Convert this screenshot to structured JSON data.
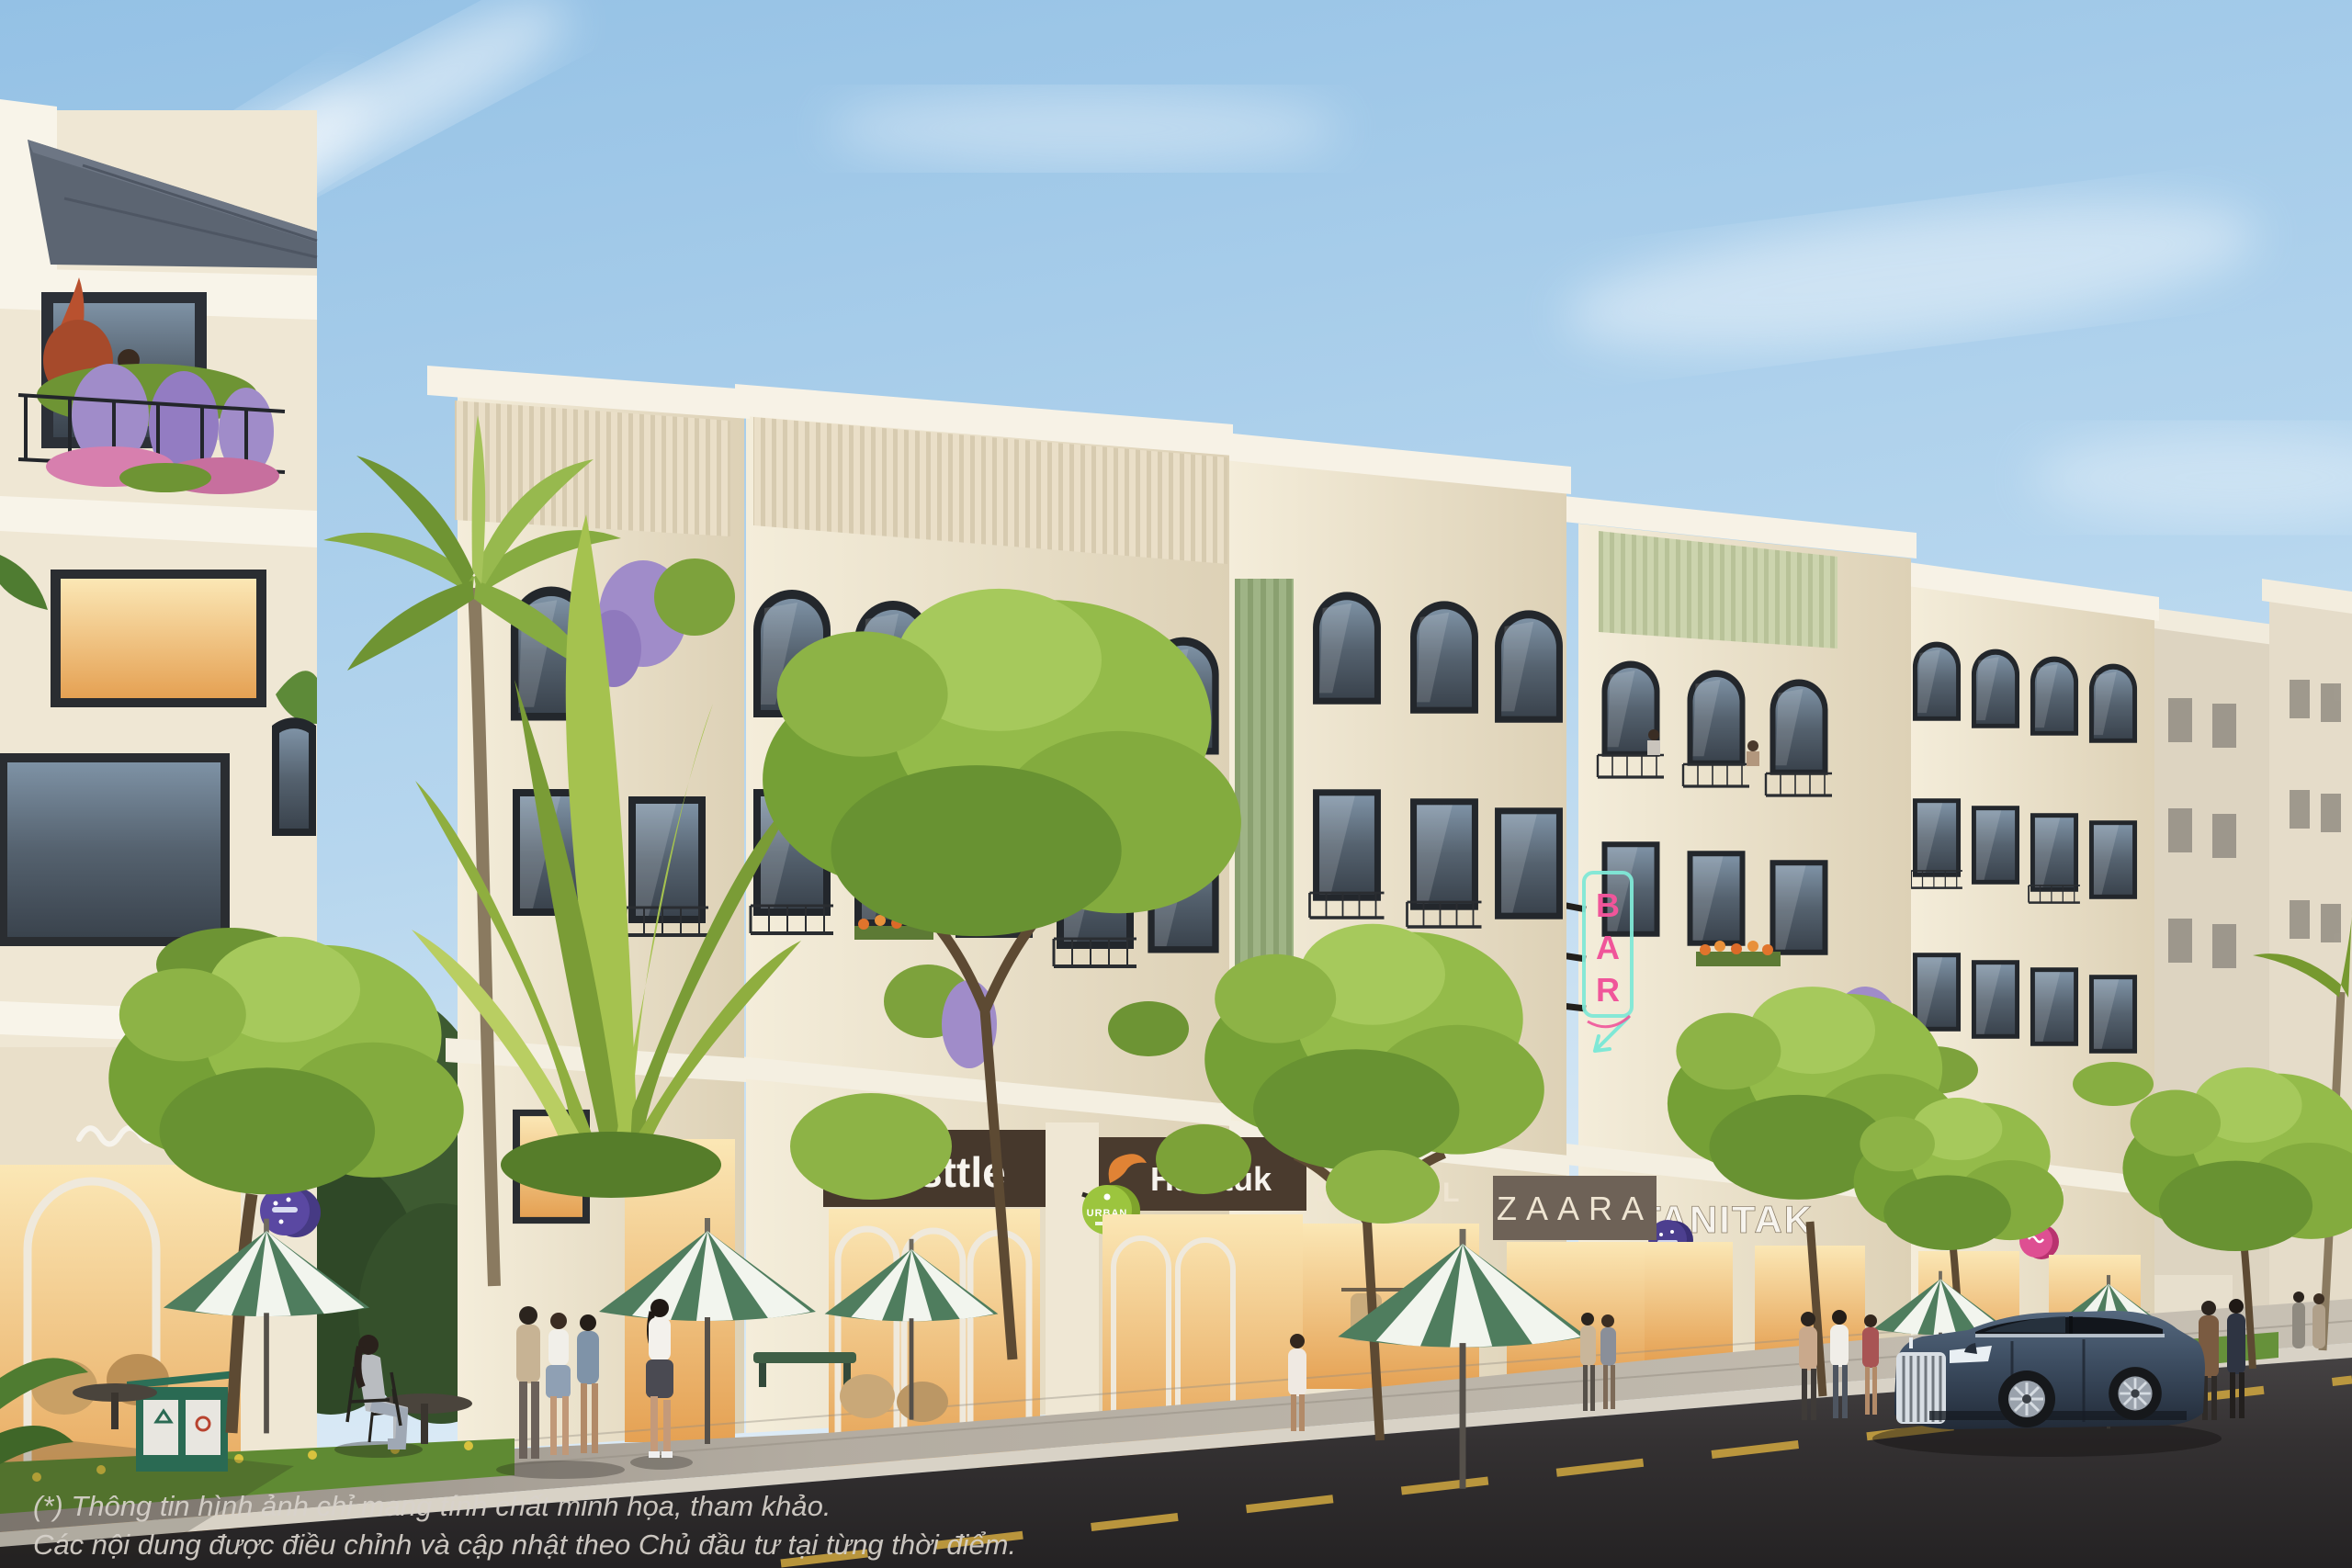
{
  "scene": {
    "type": "architectural-exterior-render",
    "description": "Street-level 3D rendering of a row of cream four-storey shophouses with retail ground floors, balconies draped in purple wisteria, street trees and palms, green-and-white striped cafe umbrellas, pedestrians and a dark blue luxury SUV on the asphalt road.",
    "disclaimer": {
      "line1": "(*) Thông tin hình ảnh chỉ mang tính chất minh họa, tham khảo.",
      "line2": "Các nội dung được điều chỉnh và cập nhật theo Chủ đầu tư tại từng thời điểm."
    }
  },
  "signs": {
    "nesttle": {
      "label": "Nesttle"
    },
    "hanituk": {
      "label": "Hanituk"
    },
    "urban_badge": {
      "label": "URBAN"
    },
    "chanel": {
      "label": "CHANEL"
    },
    "zaara": {
      "label": "ZAARA"
    },
    "tanitak": {
      "label": "TANITAK"
    },
    "bar_neon": {
      "label": "BAR",
      "letters": [
        "B",
        "A",
        "R"
      ]
    }
  },
  "colors": {
    "sky_top": "#9cc7e8",
    "sky_horizon": "#ddecf6",
    "facade_light": "#f2ead7",
    "facade_shadow": "#d6c9ae",
    "trim_white": "#f8f4e9",
    "roof_slate": "#5c6572",
    "fascia_dark_brown": "#46382c",
    "sign_white": "#f7f4ee",
    "sign_cream": "#efe5d2",
    "swoosh_orange": "#e08335",
    "urban_green": "#9cc53e",
    "blade_purple": "#4c3f8f",
    "blade_pink": "#de4f92",
    "blade_violet": "#5a48a2",
    "neon_pink": "#f0559a",
    "neon_mint": "#7fe8d6",
    "foliage_green": "#8fb344",
    "palm_green": "#86ab41",
    "wisteria_purple": "#a08cc9",
    "umbrella_green": "#4f7d5e",
    "umbrella_white": "#f2f5ee",
    "sidewalk": "#b5aea3",
    "road_asphalt": "#343132",
    "road_line_yellow": "#c9a23f",
    "car_blue": "#3c4c60"
  }
}
